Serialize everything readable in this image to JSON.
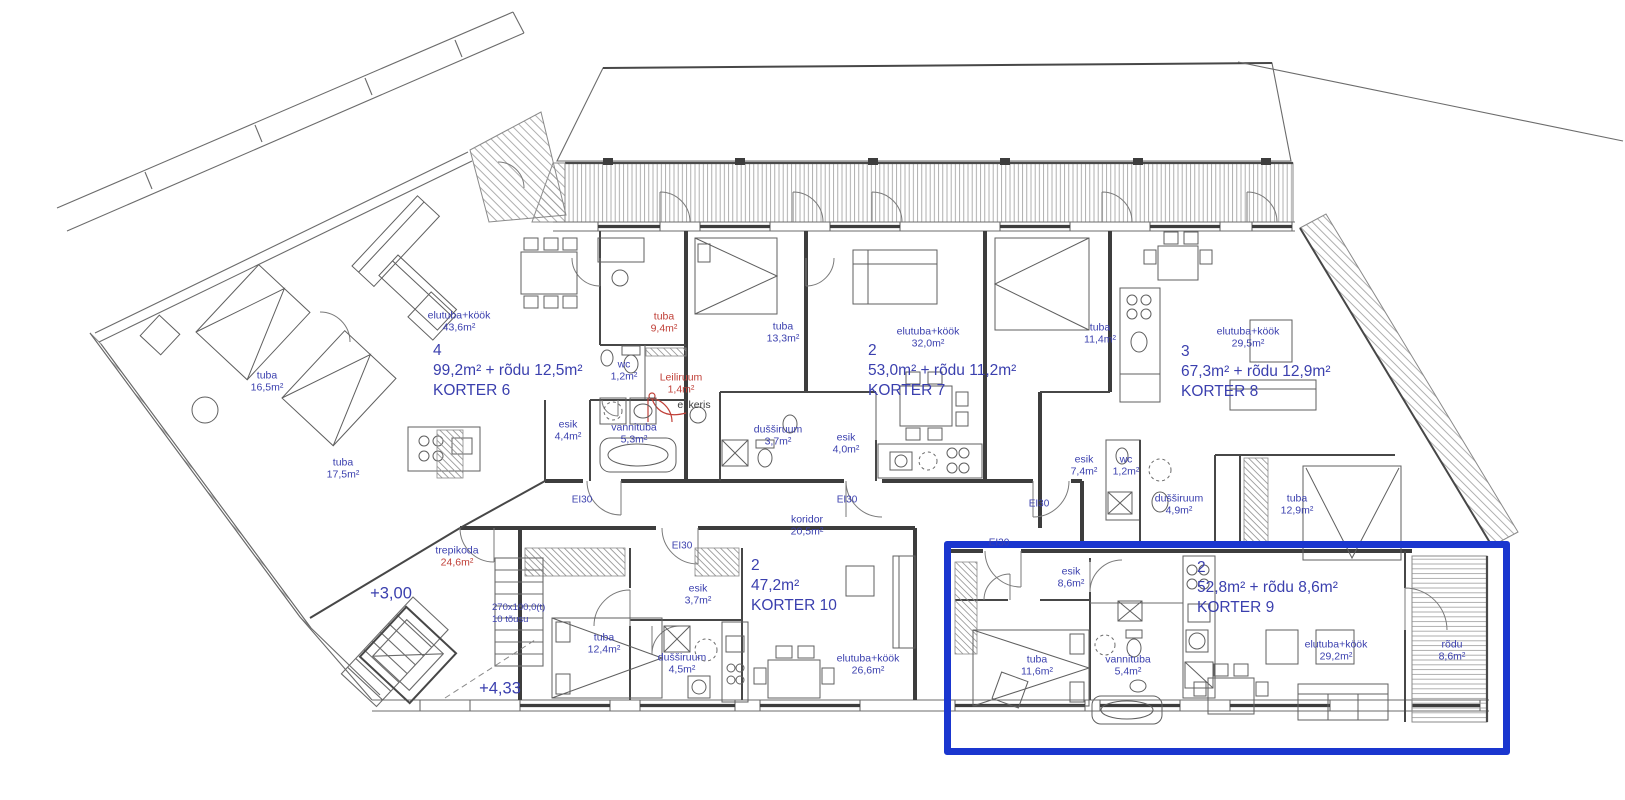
{
  "plan": {
    "background": "#ffffff",
    "wall_color": "#3d3d3d",
    "label_blue": "#3a3fae",
    "label_red": "#c04038",
    "label_dark": "#3c3c3c",
    "highlight_color": "#1a36cf"
  },
  "apartments": [
    {
      "id": "korter-6",
      "rooms": "4",
      "area": "99,2m² + rõdu 12,5m²",
      "name": "KORTER 6",
      "x": 433,
      "y": 341,
      "selected": false
    },
    {
      "id": "korter-7",
      "rooms": "2",
      "area": "53,0m² + rõdu 11,2m²",
      "name": "KORTER 7",
      "x": 868,
      "y": 341,
      "selected": false
    },
    {
      "id": "korter-8",
      "rooms": "3",
      "area": "67,3m² + rõdu 12,9m²",
      "name": "KORTER 8",
      "x": 1181,
      "y": 342,
      "selected": false
    },
    {
      "id": "korter-9",
      "rooms": "2",
      "area": "52,8m² + rõdu 8,6m²",
      "name": "KORTER 9",
      "x": 1197,
      "y": 558,
      "selected": true
    },
    {
      "id": "korter-10",
      "rooms": "2",
      "area": "47,2m²",
      "name": "KORTER 10",
      "x": 751,
      "y": 556,
      "selected": false
    }
  ],
  "room_labels": [
    {
      "name": "elutuba+köök",
      "area": "43,6m²",
      "x": 459,
      "y": 322
    },
    {
      "name": "tuba",
      "area": "16,5m²",
      "x": 267,
      "y": 382
    },
    {
      "name": "tuba",
      "area": "17,5m²",
      "x": 343,
      "y": 469
    },
    {
      "name": "tuba",
      "area": "9,4m²",
      "x": 664,
      "y": 323,
      "color": "red"
    },
    {
      "name": "wc",
      "area": "1,2m²",
      "x": 624,
      "y": 371
    },
    {
      "name": "Leiliruum",
      "area": "1,4m²",
      "x": 681,
      "y": 384,
      "color": "red"
    },
    {
      "name": "el keris",
      "x": 694,
      "y": 405,
      "color": "dark"
    },
    {
      "name": "vannituba",
      "area": "5,3m²",
      "x": 634,
      "y": 434
    },
    {
      "name": "esik",
      "area": "4,4m²",
      "x": 568,
      "y": 431
    },
    {
      "name": "tuba",
      "area": "13,3m²",
      "x": 783,
      "y": 333
    },
    {
      "name": "dušširuum",
      "area": "3,7m²",
      "x": 778,
      "y": 436
    },
    {
      "name": "esik",
      "area": "4,0m²",
      "x": 846,
      "y": 444
    },
    {
      "name": "elutuba+köök",
      "area": "32,0m²",
      "x": 928,
      "y": 338
    },
    {
      "name": "tuba",
      "area": "11,4m²",
      "x": 1100,
      "y": 334
    },
    {
      "name": "elutuba+köök",
      "area": "29,5m²",
      "x": 1248,
      "y": 338
    },
    {
      "name": "esik",
      "area": "7,4m²",
      "x": 1084,
      "y": 466
    },
    {
      "name": "wc",
      "area": "1,2m²",
      "x": 1126,
      "y": 466
    },
    {
      "name": "dušširuum",
      "area": "4,9m²",
      "x": 1179,
      "y": 505
    },
    {
      "name": "tuba",
      "area": "12,9m²",
      "x": 1297,
      "y": 505
    },
    {
      "name": "koridor",
      "area": "20,5m²",
      "x": 807,
      "y": 526
    },
    {
      "name": "trepikoda",
      "area": "24,6m²",
      "x": 457,
      "y": 557,
      "area_color": "red"
    },
    {
      "name": "esik",
      "area": "3,7m²",
      "x": 698,
      "y": 595
    },
    {
      "name": "tuba",
      "area": "12,4m²",
      "x": 604,
      "y": 644
    },
    {
      "name": "dušširuum",
      "area": "4,5m²",
      "x": 682,
      "y": 664
    },
    {
      "name": "elutuba+köök",
      "area": "26,6m²",
      "x": 868,
      "y": 665
    },
    {
      "name": "esik",
      "area": "8,6m²",
      "x": 1071,
      "y": 578
    },
    {
      "name": "tuba",
      "area": "11,6m²",
      "x": 1037,
      "y": 666
    },
    {
      "name": "vannituba",
      "area": "5,4m²",
      "x": 1128,
      "y": 666
    },
    {
      "name": "elutuba+köök",
      "area": "29,2m²",
      "x": 1336,
      "y": 651
    },
    {
      "name": "rõdu",
      "area": "8,6m²",
      "x": 1452,
      "y": 651
    }
  ],
  "fire_ratings": [
    {
      "text": "EI30",
      "x": 582,
      "y": 500
    },
    {
      "text": "EI30",
      "x": 682,
      "y": 546
    },
    {
      "text": "EI30",
      "x": 847,
      "y": 500
    },
    {
      "text": "EI30",
      "x": 1039,
      "y": 504
    },
    {
      "text": "EI30",
      "x": 999,
      "y": 543
    }
  ],
  "levels": [
    {
      "text": "+3,00",
      "x": 391,
      "y": 594
    },
    {
      "text": "+4,33",
      "x": 500,
      "y": 689
    }
  ],
  "stair_note": {
    "line1": "270x100,0(t)",
    "line2": "10 tõusu",
    "x": 492,
    "y": 602
  },
  "highlight": {
    "label": "KORTER 9",
    "x": 944,
    "y": 541,
    "width": 552,
    "height": 200
  }
}
